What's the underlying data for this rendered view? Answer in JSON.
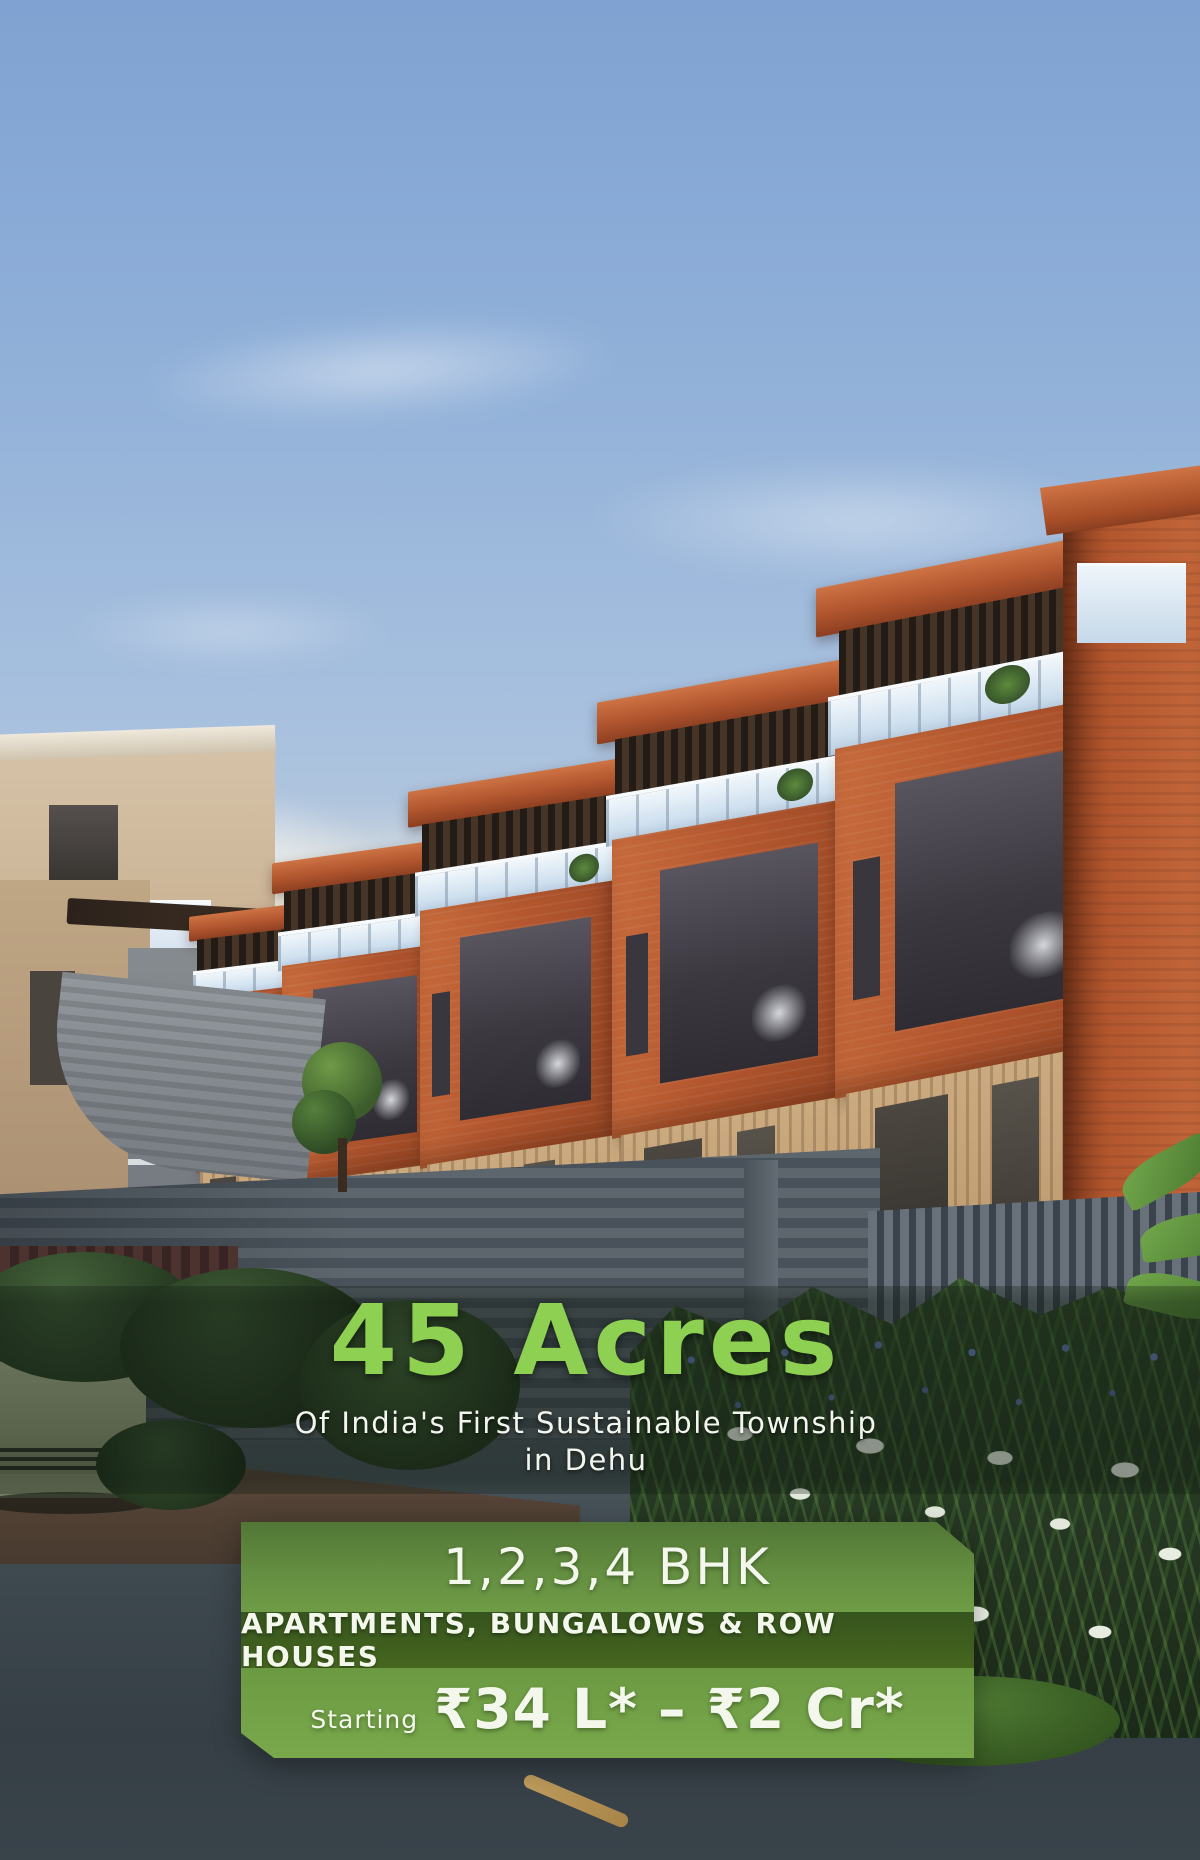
{
  "hero": {
    "headline": "45 Acres",
    "subline_1": "Of India's First Sustainable Township",
    "subline_2": "in Dehu",
    "headline_color": "#8ed051",
    "subline_color": "#f2f6ee"
  },
  "offer_banner": {
    "config_line": "1,2,3,4 BHK",
    "types_line": "APARTMENTS, BUNGALOWS & ROW HOUSES",
    "price_prefix": "Starting",
    "price_range": "₹34 L* – ₹2 Cr*",
    "panel_green_light": "#6f9c44",
    "panel_green_dark": "#46651f",
    "text_color": "#f4f7ec"
  },
  "scene": {
    "description": "3D render of terracotta brick row houses with rooftop pergolas and glass balconies, grey slat compound fence, flower bed with blue and white flowers, parked pale-green car, asphalt road and evening sky",
    "palette": {
      "sky_top": "#7fa2d2",
      "sky_horizon": "#f6ecda",
      "brick": "#b4572f",
      "timber_wall": "#c4a67e",
      "glass_railing": "#d8e7f3",
      "fence_grey": "#525b63",
      "road": "#3d474d",
      "foliage_dark": "#243820",
      "foliage_light": "#5d8a3c",
      "flower_blue": "#6277b4",
      "flower_white": "#ecf1e6",
      "car_body": "#99a37f",
      "overlay_band": "rgba(12,22,14,0.44)"
    }
  }
}
